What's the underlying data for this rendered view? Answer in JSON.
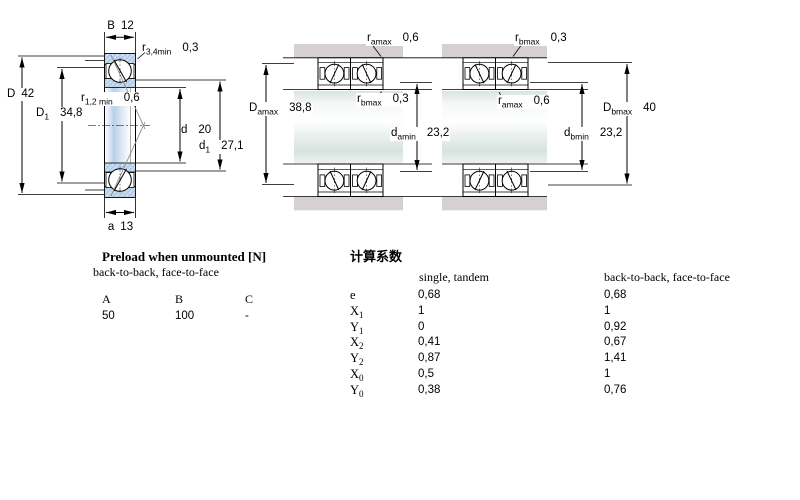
{
  "colors": {
    "bearing_hatch_blue": "#cfdff2",
    "housing_gray": "#d6d0d0",
    "line": "#000000"
  },
  "left_drawing": {
    "labels": {
      "B": {
        "sym": "B",
        "val": "12"
      },
      "r34": {
        "sym": "r",
        "sub": "3,4min",
        "val": "0,3"
      },
      "D": {
        "sym": "D",
        "val": "42"
      },
      "D1": {
        "sym": "D",
        "sub": "1",
        "val": "34,8"
      },
      "r12": {
        "sym": "r",
        "sub": "1,2 min",
        "val": "0,6"
      },
      "d": {
        "sym": "d",
        "val": "20"
      },
      "d1": {
        "sym": "d",
        "sub": "1",
        "val": "27,1"
      },
      "a": {
        "sym": "a",
        "val": "13"
      }
    }
  },
  "middle_drawing": {
    "labels": {
      "r_amax_top": {
        "sym": "r",
        "sub": "amax",
        "val": "0,6"
      },
      "D_amax": {
        "sym": "D",
        "sub": "amax",
        "val": "38,8"
      },
      "r_bmax_mid": {
        "sym": "r",
        "sub": "bmax",
        "val": "0,3"
      },
      "d_amin": {
        "sym": "d",
        "sub": "amin",
        "val": "23,2"
      }
    }
  },
  "right_drawing": {
    "labels": {
      "r_bmax_top": {
        "sym": "r",
        "sub": "bmax",
        "val": "0,3"
      },
      "r_amax_mid": {
        "sym": "r",
        "sub": "amax",
        "val": "0,6"
      },
      "D_bmax": {
        "sym": "D",
        "sub": "bmax",
        "val": "40"
      },
      "d_bmin": {
        "sym": "d",
        "sub": "bmin",
        "val": "23,2"
      }
    }
  },
  "preload_table": {
    "title": "Preload when unmounted [N]",
    "subtitle": "back-to-back, face-to-face",
    "columns": [
      "A",
      "B",
      "C"
    ],
    "values": [
      "50",
      "100",
      "-"
    ]
  },
  "factors_table": {
    "title": "计算系数",
    "col1_header": "single, tandem",
    "col2_header": "back-to-back, face-to-face",
    "rows": [
      {
        "sym": "e",
        "sub": "",
        "v1": "0,68",
        "v2": "0,68"
      },
      {
        "sym": "X",
        "sub": "1",
        "v1": "1",
        "v2": "1"
      },
      {
        "sym": "Y",
        "sub": "1",
        "v1": "0",
        "v2": "0,92"
      },
      {
        "sym": "X",
        "sub": "2",
        "v1": "0,41",
        "v2": "0,67"
      },
      {
        "sym": "Y",
        "sub": "2",
        "v1": "0,87",
        "v2": "1,41"
      },
      {
        "sym": "X",
        "sub": "0",
        "v1": "0,5",
        "v2": "1"
      },
      {
        "sym": "Y",
        "sub": "0",
        "v1": "0,38",
        "v2": "0,76"
      }
    ]
  }
}
